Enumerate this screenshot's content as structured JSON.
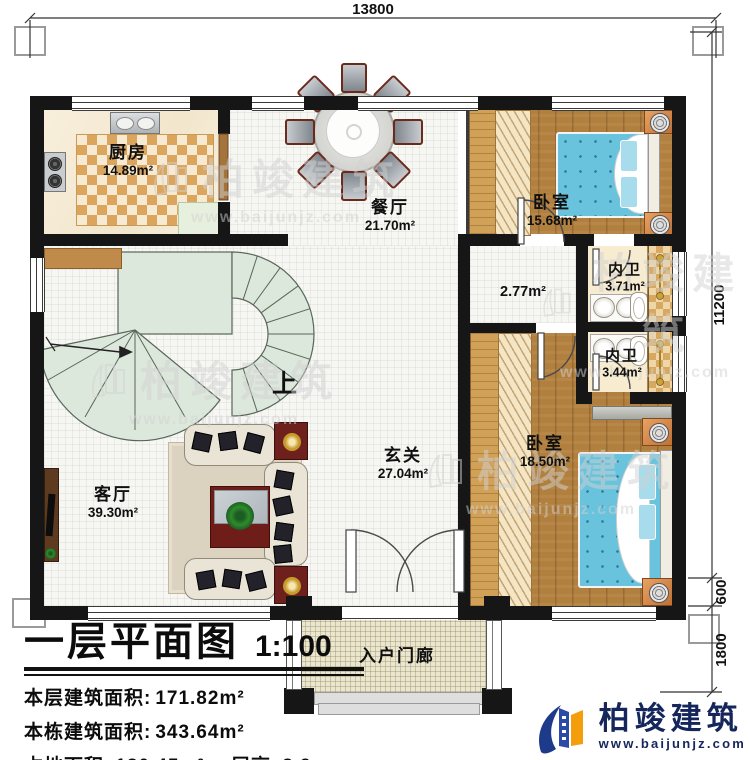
{
  "dimensions": {
    "top": "13800",
    "right_upper": "11200",
    "right_mid": "600",
    "right_lower": "1800"
  },
  "rooms": [
    {
      "name": "厨房",
      "area": "14.89m²"
    },
    {
      "name": "餐厅",
      "area": "21.70m²"
    },
    {
      "name": "卧室",
      "area": "15.68m²"
    },
    {
      "name": "",
      "area": "2.77m²"
    },
    {
      "name": "内卫",
      "area": "3.71m²"
    },
    {
      "name": "内卫",
      "area": "3.44m²"
    },
    {
      "name": "卧室",
      "area": "18.50m²"
    },
    {
      "name": "玄关",
      "area": "27.04m²"
    },
    {
      "name": "客厅",
      "area": "39.30m²"
    },
    {
      "name": "入户门廊",
      "area": ""
    }
  ],
  "stairs": {
    "up_label": "上"
  },
  "title_block": {
    "plan_name": "一层平面图",
    "scale": "1:100",
    "line1_label": "本层建筑面积:",
    "line1_value": "171.82m²",
    "line2_label": "本栋建筑面积:",
    "line2_value": "343.64m²",
    "line3_label": "占地面积:",
    "line3_value": "180.45m²",
    "line4_label": "层高:",
    "line4_value": "3.9m"
  },
  "brand": {
    "name": "柏竣建筑",
    "website": "www.baijunjz.com"
  },
  "watermark": {
    "name": "柏竣建筑",
    "website": "www.baijunjz.com"
  },
  "colors": {
    "wall": "#161616",
    "wood": "#b1803e",
    "bed": "#69c3dc",
    "stair": "#dde8dc",
    "brand_blue": "#1e3a8a",
    "brand_orange": "#f59e0b",
    "accent_red": "#6e1d18"
  }
}
